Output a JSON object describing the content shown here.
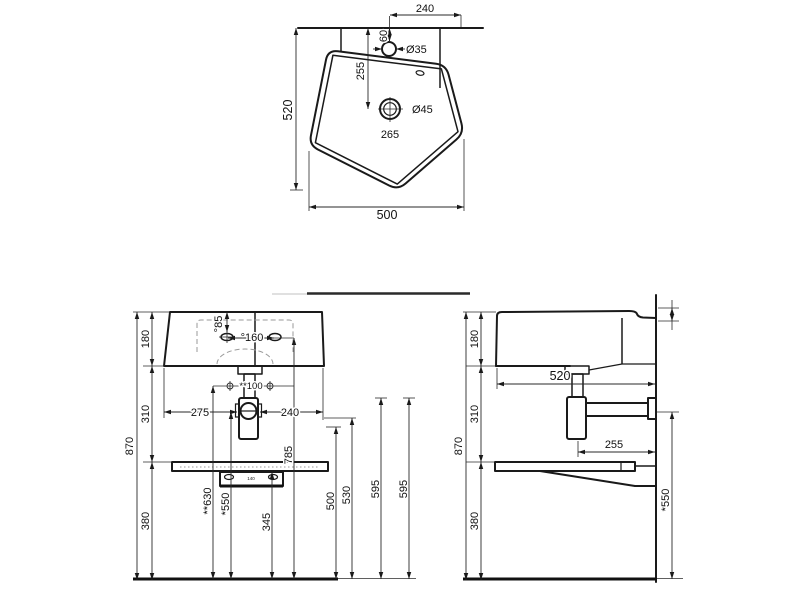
{
  "drawing": {
    "colors": {
      "object_line": "#1a1a1a",
      "dimension_line": "#2a2a2a",
      "hidden_line": "#9a9a9a",
      "background": "#ffffff"
    },
    "top_view": {
      "dim_faucet_to_edge": "240",
      "dim_faucet_offset": "60",
      "faucet_hole_diameter": "Ø35",
      "dim_wall_to_drain": "255",
      "drain_hole_diameter": "Ø45",
      "dim_drain_to_front": "265",
      "dim_overall_depth": "520",
      "dim_overall_width": "500"
    },
    "front_view": {
      "dim_basin_height": "180",
      "dim_total_height": "870",
      "dim_mid_height": "310",
      "dim_lower_height": "380",
      "dim_hole_drop": "°85",
      "dim_hole_spacing": "°160",
      "dim_fixing_spacing": "**100",
      "dim_left_span": "275",
      "dim_right_span": "240",
      "dim_bracket_width": "140",
      "dim_fixing_height": "**630",
      "dim_trap_height": "*550",
      "dim_shelf_height": "345",
      "dim_rim_holes_height": "785",
      "dim_h500": "500",
      "dim_h530": "530",
      "dim_h595a": "595",
      "dim_h595b": "595"
    },
    "side_view": {
      "dim_basin_height": "180",
      "dim_total_height": "870",
      "dim_mid_height": "310",
      "dim_lower_height": "380",
      "dim_overall_depth": "520",
      "dim_trap_to_wall": "255",
      "dim_outlet_height": "*550"
    }
  }
}
